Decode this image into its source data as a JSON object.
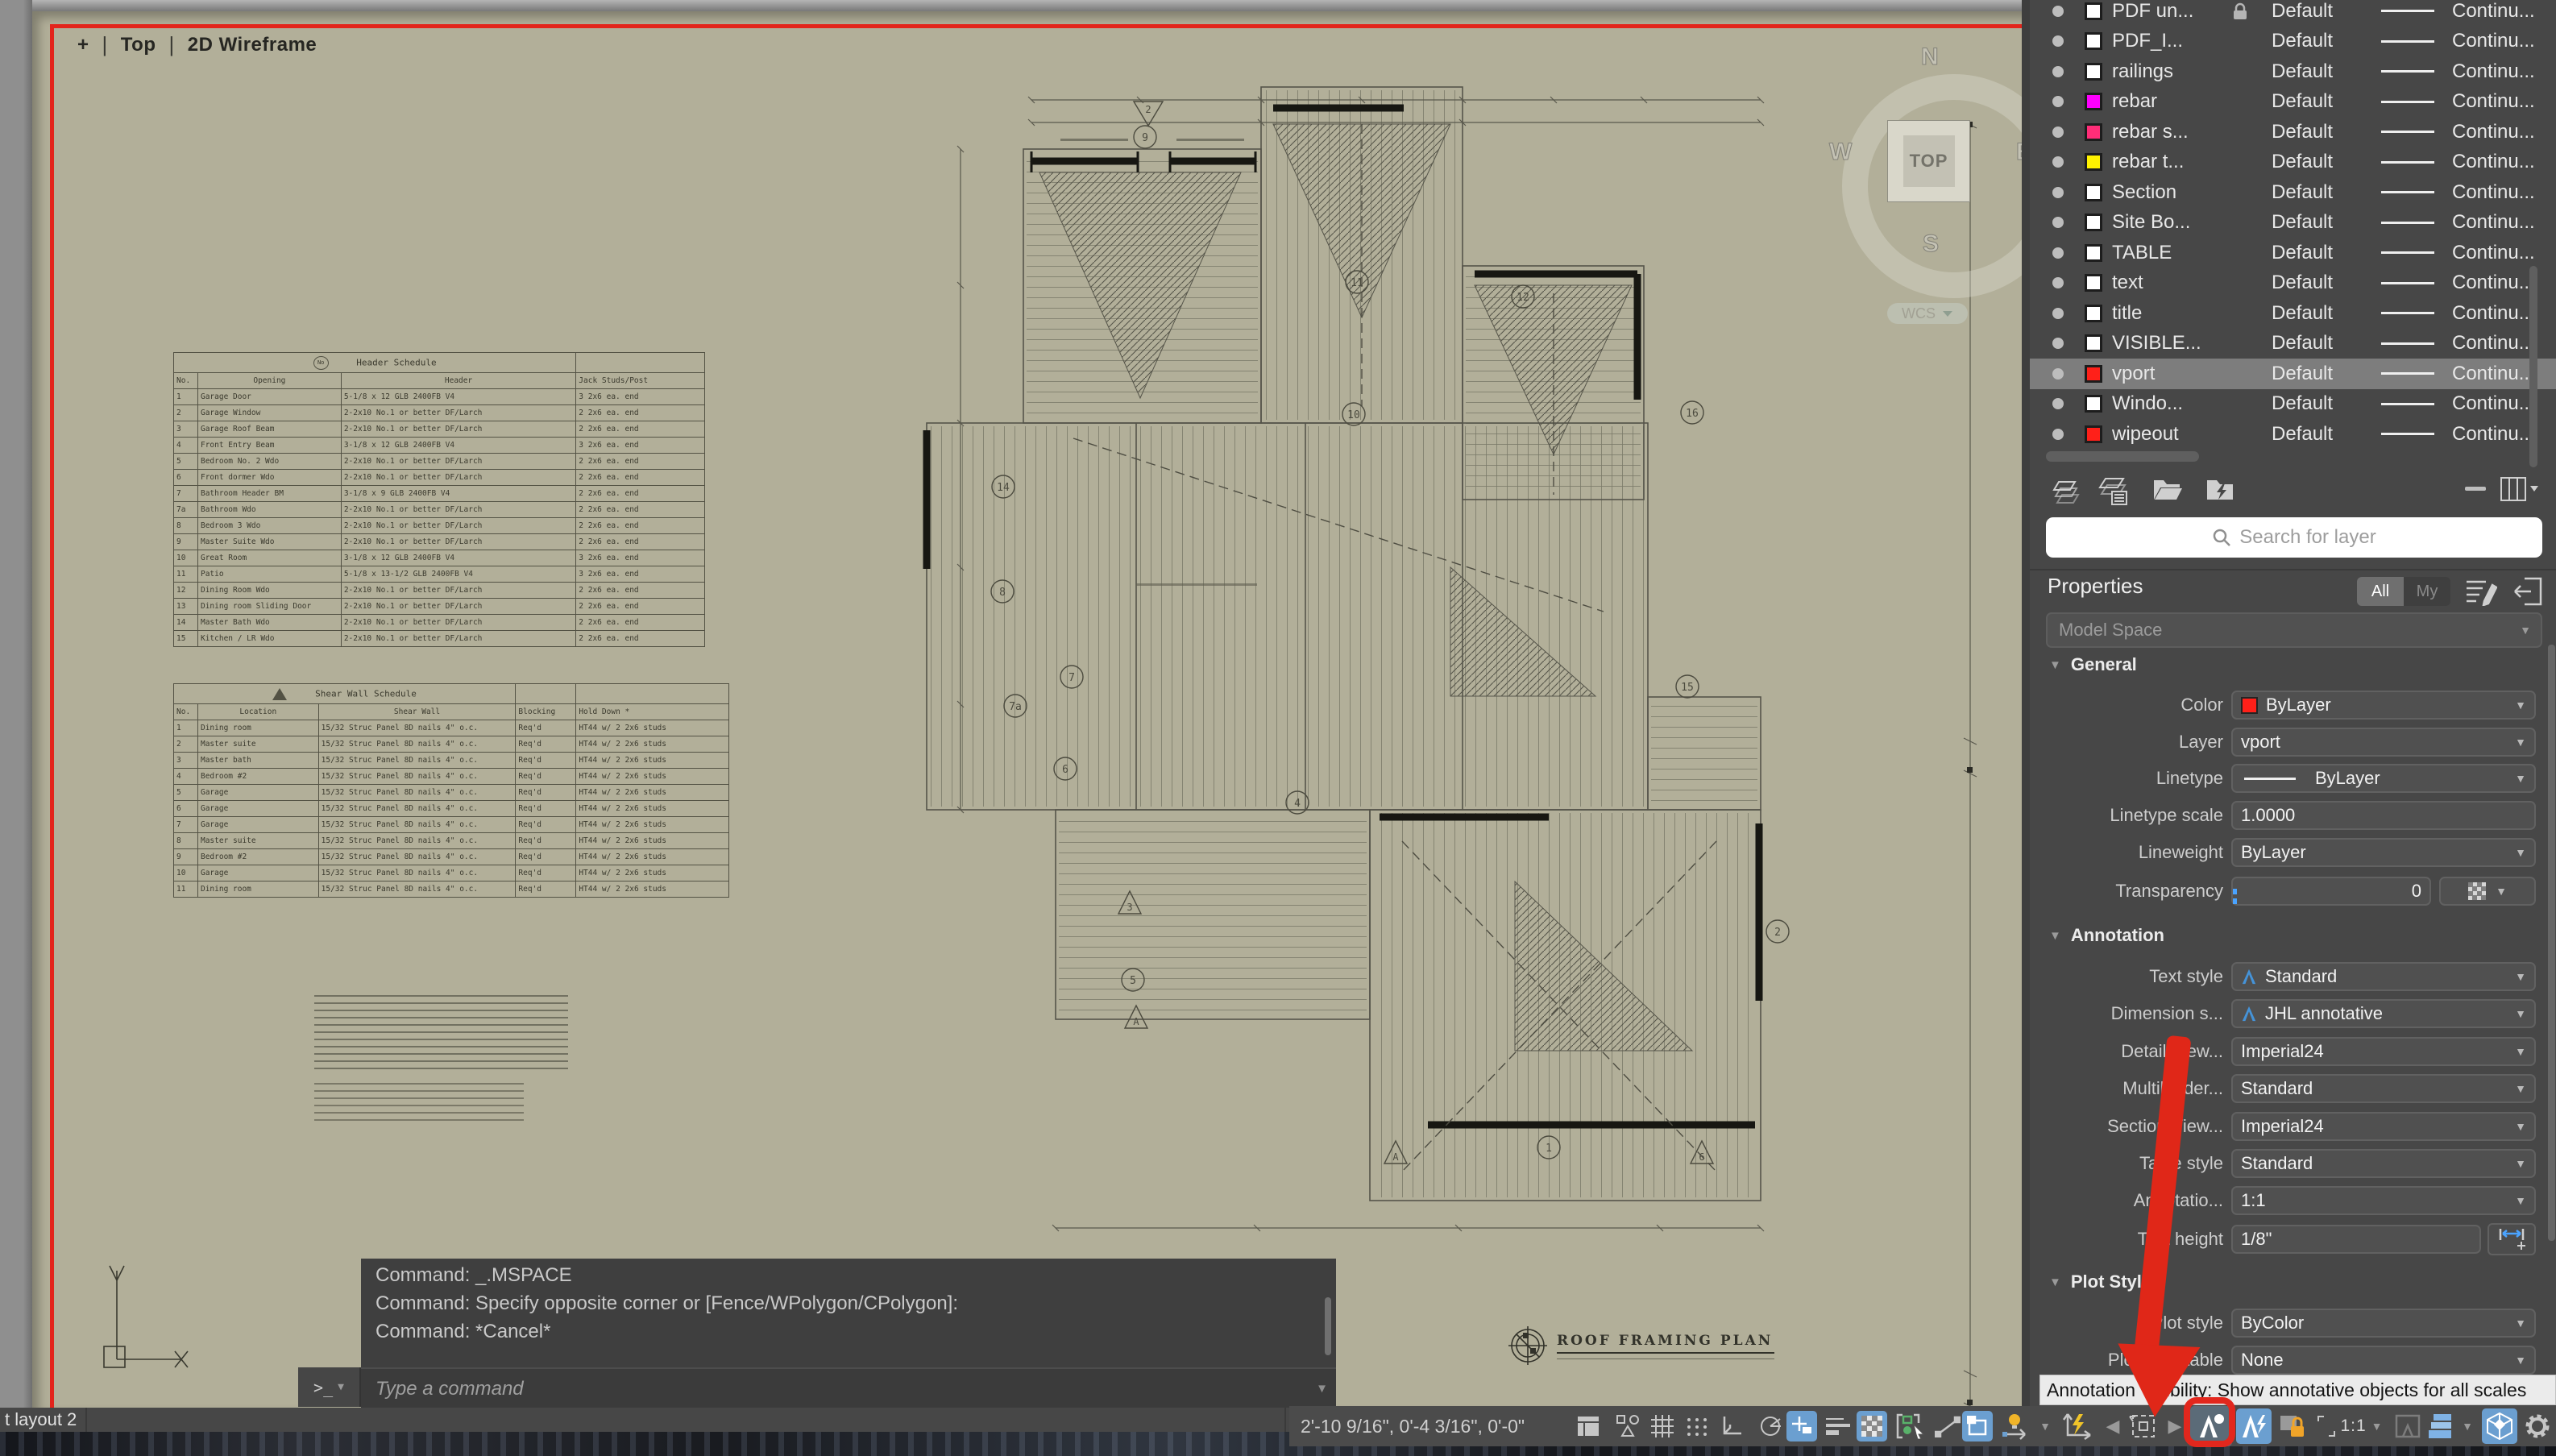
{
  "viewport_controls": {
    "plus": "+",
    "view": "Top",
    "visual_style": "2D Wireframe"
  },
  "viewcube": {
    "north": "N",
    "west": "W",
    "east": "E",
    "south": "S",
    "face": "TOP",
    "wcs": "WCS"
  },
  "drawing": {
    "title": "ROOF FRAMING PLAN",
    "header_schedule": {
      "note_label": "No",
      "title": "Header Schedule",
      "columns": [
        "No.",
        "Opening",
        "Header",
        "Jack Studs/Post"
      ],
      "rows": [
        [
          "1",
          "Garage Door",
          "5-1/8 x 12 GLB 2400FB V4",
          "3 2x6 ea. end"
        ],
        [
          "2",
          "Garage Window",
          "2-2x10 No.1 or better DF/Larch",
          "2 2x6 ea. end"
        ],
        [
          "3",
          "Garage Roof Beam",
          "2-2x10 No.1 or better DF/Larch",
          "2 2x6 ea. end"
        ],
        [
          "4",
          "Front Entry Beam",
          "3-1/8 x 12 GLB 2400FB V4",
          "3 2x6 ea. end"
        ],
        [
          "5",
          "Bedroom No. 2 Wdo",
          "2-2x10 No.1 or better DF/Larch",
          "2 2x6 ea. end"
        ],
        [
          "6",
          "Front dormer Wdo",
          "2-2x10 No.1 or better DF/Larch",
          "2 2x6 ea. end"
        ],
        [
          "7",
          "Bathroom Header BM",
          "3-1/8 x 9 GLB 2400FB V4",
          "2 2x6 ea. end"
        ],
        [
          "7a",
          "Bathroom Wdo",
          "2-2x10 No.1 or better DF/Larch",
          "2 2x6 ea. end"
        ],
        [
          "8",
          "Bedroom 3 Wdo",
          "2-2x10 No.1 or better DF/Larch",
          "2 2x6 ea. end"
        ],
        [
          "9",
          "Master Suite Wdo",
          "2-2x10 No.1 or better DF/Larch",
          "2 2x6 ea. end"
        ],
        [
          "10",
          "Great Room",
          "3-1/8 x 12 GLB 2400FB V4",
          "3 2x6 ea. end"
        ],
        [
          "11",
          "Patio",
          "5-1/8 x 13-1/2 GLB 2400FB V4",
          "3 2x6 ea. end"
        ],
        [
          "12",
          "Dining Room Wdo",
          "2-2x10 No.1 or better DF/Larch",
          "2 2x6 ea. end"
        ],
        [
          "13",
          "Dining room Sliding Door",
          "2-2x10 No.1 or better DF/Larch",
          "2 2x6 ea. end"
        ],
        [
          "14",
          "Master Bath Wdo",
          "2-2x10 No.1 or better DF/Larch",
          "2 2x6 ea. end"
        ],
        [
          "15",
          "Kitchen / LR Wdo",
          "2-2x10 No.1 or better DF/Larch",
          "2 2x6 ea. end"
        ]
      ]
    },
    "shear_wall_schedule": {
      "note_label": "No",
      "title": "Shear Wall Schedule",
      "columns": [
        "No.",
        "Location",
        "Shear Wall",
        "Blocking",
        "Hold Down  *"
      ],
      "rows": [
        [
          "1",
          "Dining room",
          "15/32 Struc Panel 8D nails 4\" o.c.",
          "Req'd",
          "HT44 w/ 2 2x6 studs"
        ],
        [
          "2",
          "Master suite",
          "15/32 Struc Panel 8D nails 4\" o.c.",
          "Req'd",
          "HT44 w/ 2 2x6 studs"
        ],
        [
          "3",
          "Master bath",
          "15/32 Struc Panel 8D nails 4\" o.c.",
          "Req'd",
          "HT44 w/ 2 2x6 studs"
        ],
        [
          "4",
          "Bedroom #2",
          "15/32 Struc Panel 8D nails 4\" o.c.",
          "Req'd",
          "HT44 w/ 2 2x6 studs"
        ],
        [
          "5",
          "Garage",
          "15/32 Struc Panel 8D nails 4\" o.c.",
          "Req'd",
          "HT44 w/ 2 2x6 studs"
        ],
        [
          "6",
          "Garage",
          "15/32 Struc Panel 8D nails 4\" o.c.",
          "Req'd",
          "HT44 w/ 2 2x6 studs"
        ],
        [
          "7",
          "Garage",
          "15/32 Struc Panel 8D nails 4\" o.c.",
          "Req'd",
          "HT44 w/ 2 2x6 studs"
        ],
        [
          "8",
          "Master suite",
          "15/32 Struc Panel 8D nails 4\" o.c.",
          "Req'd",
          "HT44 w/ 2 2x6 studs"
        ],
        [
          "9",
          "Bedroom #2",
          "15/32 Struc Panel 8D nails 4\" o.c.",
          "Req'd",
          "HT44 w/ 2 2x6 studs"
        ],
        [
          "10",
          "Garage",
          "15/32 Struc Panel 8D nails 4\" o.c.",
          "Req'd",
          "HT44 w/ 2 2x6 studs"
        ],
        [
          "11",
          "Dining room",
          "15/32 Struc Panel 8D nails 4\" o.c.",
          "Req'd",
          "HT44 w/ 2 2x6 studs"
        ]
      ]
    },
    "callouts": {
      "circles": [
        "9",
        "11",
        "12",
        "16",
        "10",
        "15",
        "2",
        "8",
        "7a",
        "6",
        "4",
        "5",
        "14",
        "7"
      ],
      "triangles": [
        "2",
        "A",
        "6",
        "1",
        "A",
        "3"
      ]
    }
  },
  "layers_panel": {
    "search_placeholder": "Search for layer",
    "rows": [
      {
        "name": "PDF un...",
        "color": "#ffffff",
        "locked": true,
        "lineweight": "Default",
        "linetype": "Continu..."
      },
      {
        "name": "PDF_I...",
        "color": "#ffffff",
        "lineweight": "Default",
        "linetype": "Continu..."
      },
      {
        "name": "railings",
        "color": "#ffffff",
        "lineweight": "Default",
        "linetype": "Continu..."
      },
      {
        "name": "rebar",
        "color": "#ff00ff",
        "lineweight": "Default",
        "linetype": "Continu..."
      },
      {
        "name": "rebar s...",
        "color": "#ff2d78",
        "lineweight": "Default",
        "linetype": "Continu..."
      },
      {
        "name": "rebar t...",
        "color": "#fff200",
        "lineweight": "Default",
        "linetype": "Continu..."
      },
      {
        "name": "Section",
        "color": "#ffffff",
        "lineweight": "Default",
        "linetype": "Continu..."
      },
      {
        "name": "Site Bo...",
        "color": "#ffffff",
        "lineweight": "Default",
        "linetype": "Continu..."
      },
      {
        "name": "TABLE",
        "color": "#ffffff",
        "lineweight": "Default",
        "linetype": "Continu..."
      },
      {
        "name": "text",
        "color": "#ffffff",
        "lineweight": "Default",
        "linetype": "Continu..."
      },
      {
        "name": "title",
        "color": "#ffffff",
        "lineweight": "Default",
        "linetype": "Continu..."
      },
      {
        "name": "VISIBLE...",
        "color": "#ffffff",
        "lineweight": "Default",
        "linetype": "Continu..."
      },
      {
        "name": "vport",
        "color": "#ff2019",
        "selected": true,
        "lineweight": "Default",
        "linetype": "Continu..."
      },
      {
        "name": "Windo...",
        "color": "#ffffff",
        "lineweight": "Default",
        "linetype": "Continu..."
      },
      {
        "name": "wipeout",
        "color": "#ff2019",
        "lineweight": "Default",
        "linetype": "Continu..."
      }
    ]
  },
  "properties": {
    "title": "Properties",
    "filters": {
      "all": "All",
      "my": "My"
    },
    "space": "Model Space",
    "general": {
      "header": "General",
      "color": {
        "label": "Color",
        "value": "ByLayer"
      },
      "layer": {
        "label": "Layer",
        "value": "vport"
      },
      "linetype": {
        "label": "Linetype",
        "value": "ByLayer"
      },
      "linetype_scale": {
        "label": "Linetype scale",
        "value": "1.0000"
      },
      "lineweight": {
        "label": "Lineweight",
        "value": "ByLayer"
      },
      "transparency": {
        "label": "Transparency",
        "value": "0"
      }
    },
    "annotation": {
      "header": "Annotation",
      "text_style": {
        "label": "Text style",
        "value": "Standard"
      },
      "dim_style": {
        "label": "Dimension s...",
        "value": "JHL annotative"
      },
      "detail_view": {
        "label": "Detail View...",
        "value": "Imperial24"
      },
      "multileader": {
        "label": "Multileader...",
        "value": "Standard"
      },
      "section_view": {
        "label": "Section View...",
        "value": "Imperial24"
      },
      "table_style": {
        "label": "Table style",
        "value": "Standard"
      },
      "annotation_scale": {
        "label": "Annotatio...",
        "value": "1:1"
      },
      "text_height": {
        "label": "Text height",
        "value": "1/8\""
      }
    },
    "plot": {
      "header": "Plot Style",
      "plot_style": {
        "label": "Plot style",
        "value": "ByColor"
      },
      "plot_style_table": {
        "label": "Plot style table",
        "value": "None"
      }
    }
  },
  "command_line": {
    "history": [
      "Command: _.MSPACE",
      "Command: Specify opposite corner or [Fence/WPolygon/CPolygon]:",
      "Command: *Cancel*"
    ],
    "prompt": ">_",
    "placeholder": "Type a command"
  },
  "layout_tabs": {
    "active": "t layout 2"
  },
  "status_bar": {
    "coordinates": "2'-10 9/16\",  0'-4 3/16\", 0'-0\"",
    "viewport_scale": "1:1",
    "icons": [
      "layout",
      "object-snap-shapes",
      "grid",
      "snap-dots",
      "ortho",
      "polar-tracking",
      "osnap-marker",
      "lineweight-display",
      "transparency",
      "isolate-objects",
      "dynamic-input",
      "viewport",
      "annotation-monitor",
      "ucs-dynamic",
      "previous",
      "selection-cycling",
      "next",
      "annotation-visibility",
      "annotation-autoscale",
      "lock-ui",
      "viewport-scale",
      "viewport-faded",
      "sheet-set",
      "workspace-cube",
      "settings-gear"
    ]
  },
  "tooltip": "Annotation Visibility: Show annotative objects for all scales",
  "accent_colors": {
    "viewport_border": "#e3241b",
    "highlight_red": "#e02718",
    "selection_blue": "#6b9fd0"
  }
}
